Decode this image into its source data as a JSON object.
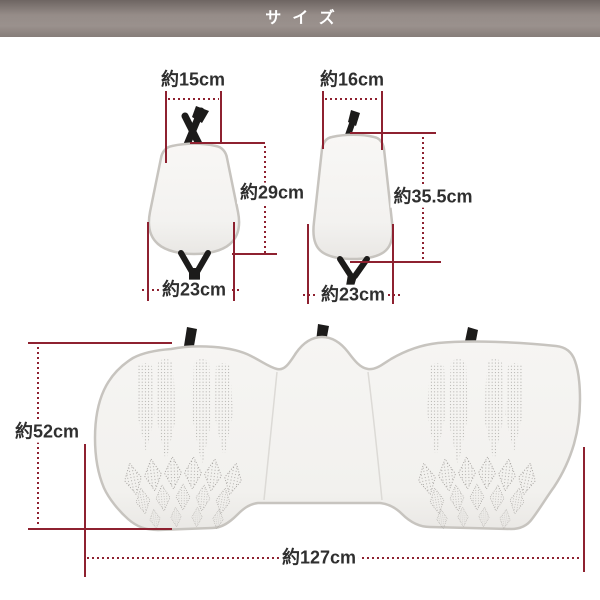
{
  "header": {
    "title": "サイズ"
  },
  "colors": {
    "accent": "#8e2130",
    "text": "#2f2f2f",
    "header_top": "#6e6562",
    "header_mid": "#9a918d",
    "header_bottom": "#867d79",
    "cushion_fill": "#f4f3f1",
    "cushion_edge": "#c7c4bf",
    "strap": "#1c1b1a",
    "perforation": "#9f9d99"
  },
  "measurements": {
    "back_small": {
      "top_width": "約15cm",
      "height": "約29cm",
      "bottom_width": "約23cm"
    },
    "back_large": {
      "top_width": "約16cm",
      "height": "約35.5cm",
      "bottom_width": "約23cm"
    },
    "bench": {
      "height": "約52cm",
      "width": "約127cm"
    }
  }
}
